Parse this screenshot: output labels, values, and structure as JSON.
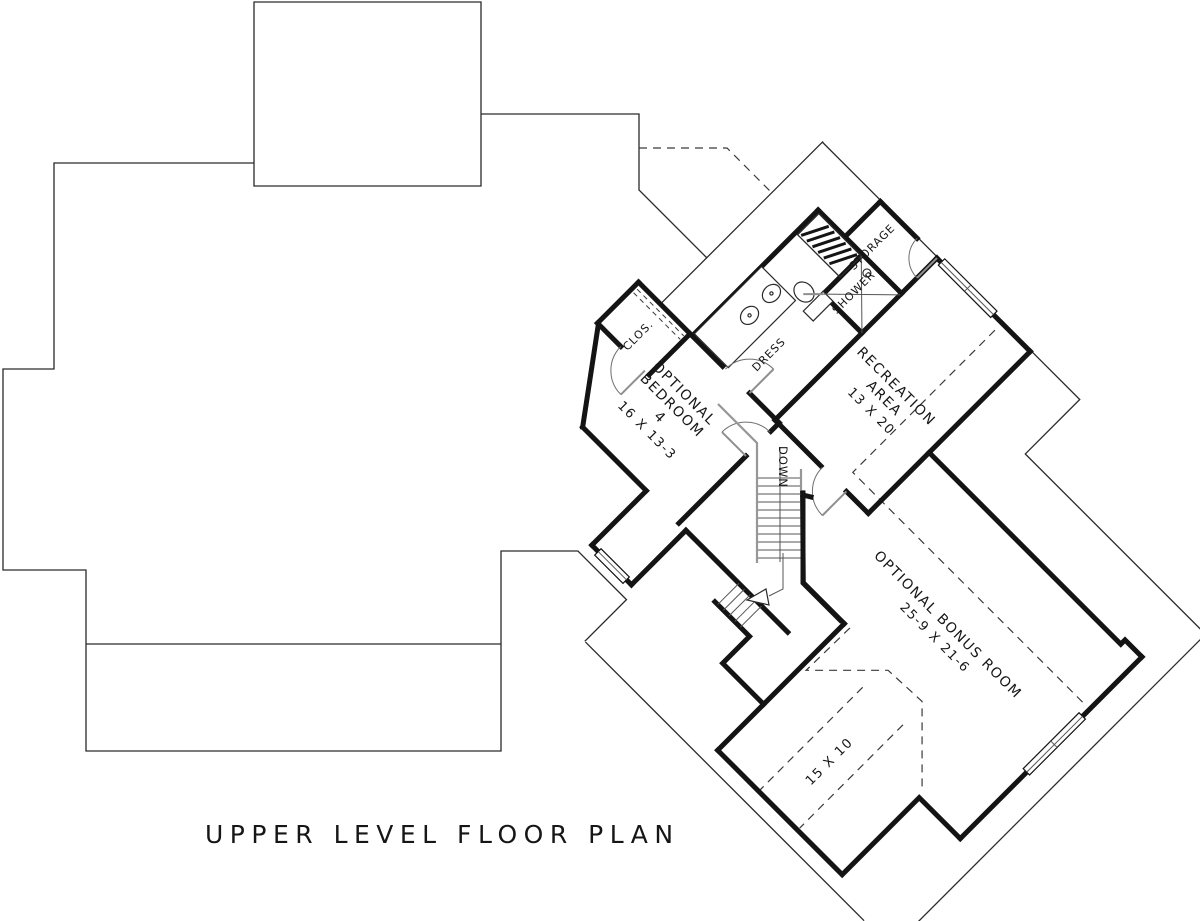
{
  "title": "UPPER LEVEL FLOOR PLAN",
  "colors": {
    "ink": "#141414",
    "thin_line": "#2a2a2a",
    "railing_gray": "#979797",
    "background": "#ffffff"
  },
  "rooms": {
    "optional_bedroom": {
      "lines": [
        "OPTIONAL",
        "BEDROOM",
        "4"
      ],
      "dims": "16 X 13-3"
    },
    "recreation_area": {
      "lines": [
        "RECREATION",
        "AREA"
      ],
      "dims": "13 X 20"
    },
    "optional_bonus_room": {
      "name": "OPTIONAL BONUS ROOM",
      "dims": "25-9 X 21-6"
    },
    "bonus_alcove": {
      "dims": "15 X 10"
    },
    "closet": {
      "label": "CLOS."
    },
    "dressing": {
      "label": "DRESS"
    },
    "shower": {
      "label": "SHOWER"
    },
    "storage": {
      "label": "STORAGE"
    }
  },
  "stairs": {
    "label": "DOWN"
  }
}
